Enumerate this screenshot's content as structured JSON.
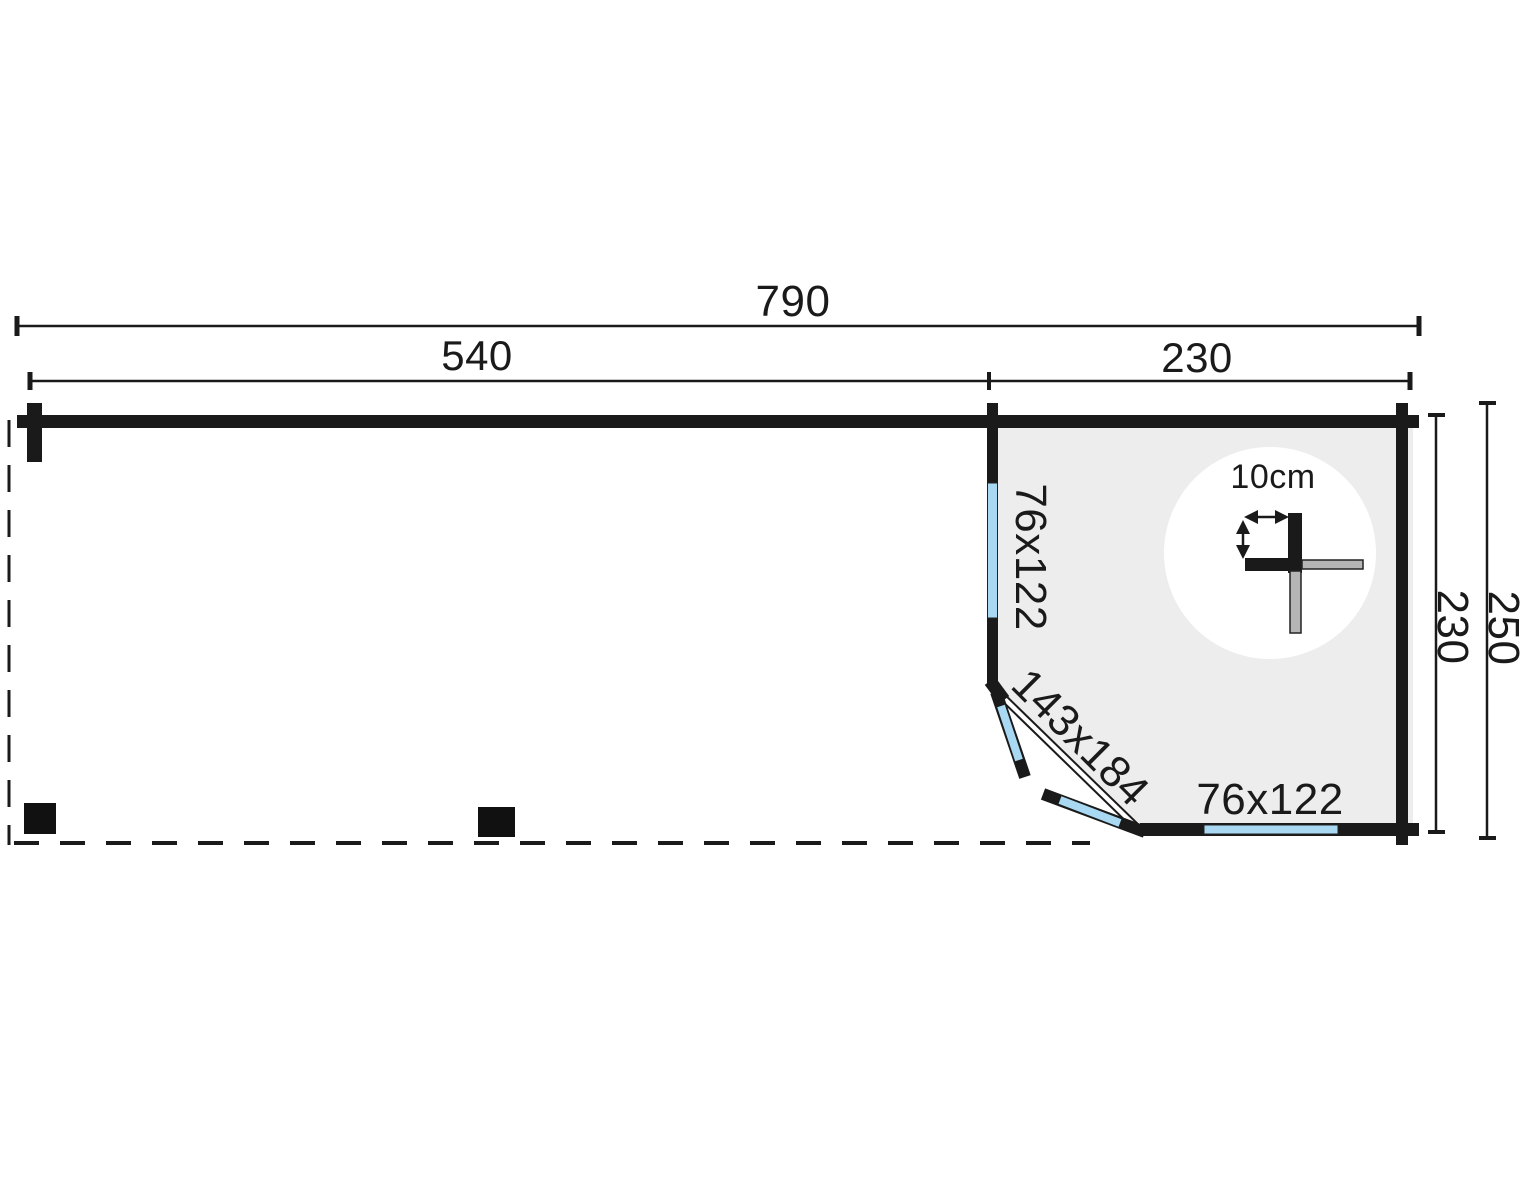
{
  "diagram": {
    "dims": {
      "total_width": "790",
      "canopy_width": "540",
      "cabin_width": "230",
      "cabin_depth": "230",
      "total_depth": "250"
    },
    "labels": {
      "window_left": "76x122",
      "door": "143x184",
      "window_bottom": "76x122",
      "wall_thickness": "10cm"
    },
    "colors": {
      "wall": "#1a1a1a",
      "interior_fill": "#ededee",
      "window_glass": "#a9d9f2",
      "detail_gray": "#b5b5b5"
    }
  }
}
